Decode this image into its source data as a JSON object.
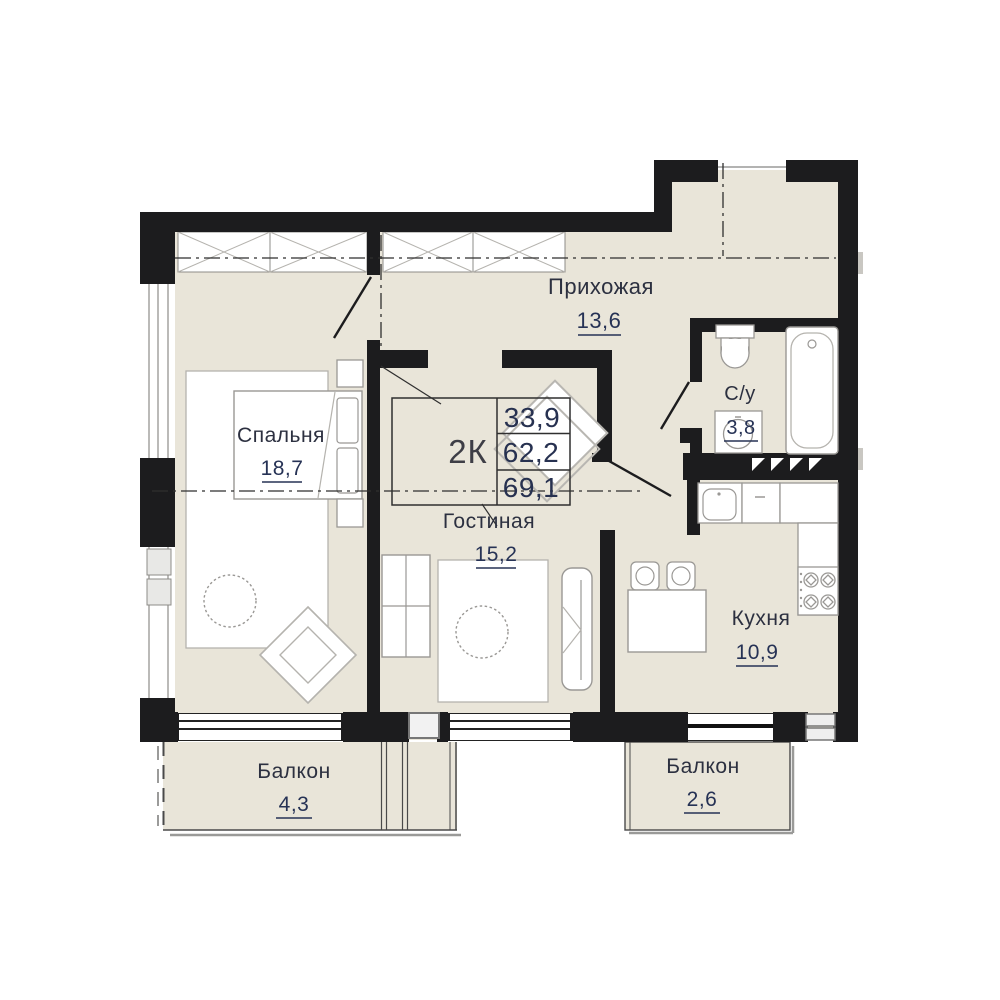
{
  "apartment": {
    "type_label": "2К",
    "values": {
      "row1": "33,9",
      "row2": "62,2",
      "row3": "69,1"
    }
  },
  "rooms": {
    "hallway": {
      "name": "Прихожая",
      "area": "13,6"
    },
    "bedroom": {
      "name": "Спальня",
      "area": "18,7"
    },
    "living": {
      "name": "Гостиная",
      "area": "15,2"
    },
    "kitchen": {
      "name": "Кухня",
      "area": "10,9"
    },
    "bathroom": {
      "name": "С/у",
      "area": "3,8"
    },
    "balcony_left": {
      "name": "Балкон",
      "area": "4,3"
    },
    "balcony_right": {
      "name": "Балкон",
      "area": "2,6"
    }
  },
  "colors": {
    "wall": "#1c1c1e",
    "floor": "#e9e5d9",
    "fixture_line": "#9a9895",
    "light_line": "#b8b6b1",
    "text_dark": "#2c3040",
    "text_number": "#263255"
  }
}
